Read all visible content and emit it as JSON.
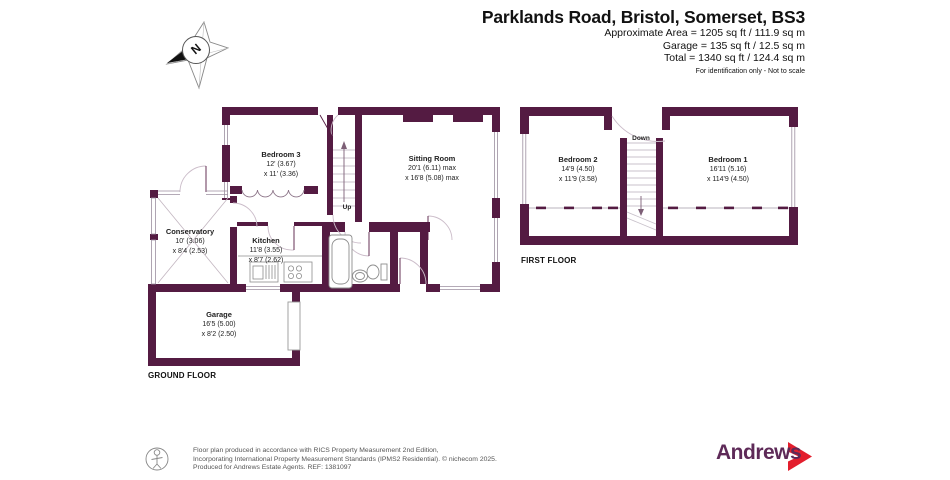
{
  "header": {
    "title": "Parklands Road, Bristol, Somerset, BS3",
    "area_lines": {
      "approx": "Approximate Area = 1205 sq ft / 111.9 sq m",
      "garage": "Garage = 135 sq ft / 12.5 sq m",
      "total": "Total = 1340 sq ft / 124.4 sq m"
    },
    "disclaimer": "For identification only - Not to scale"
  },
  "compass": {
    "north_label": "N"
  },
  "ground_floor": {
    "label": "GROUND FLOOR",
    "stairs_label": "Up",
    "rooms": {
      "bedroom3": {
        "name": "Bedroom 3",
        "dim1": "12' (3.67)",
        "dim2": "x 11' (3.36)"
      },
      "sitting_room": {
        "name": "Sitting Room",
        "dim1": "20'1 (6.11) max",
        "dim2": "x 16'8 (5.08) max"
      },
      "conservatory": {
        "name": "Conservatory",
        "dim1": "10' (3.06)",
        "dim2": "x 8'4 (2.53)"
      },
      "kitchen": {
        "name": "Kitchen",
        "dim1": "11'8 (3.55)",
        "dim2": "x 8'7 (2.62)"
      },
      "garage": {
        "name": "Garage",
        "dim1": "16'5 (5.00)",
        "dim2": "x 8'2 (2.50)"
      }
    }
  },
  "first_floor": {
    "label": "FIRST FLOOR",
    "stairs_label": "Down",
    "rooms": {
      "bedroom2": {
        "name": "Bedroom 2",
        "dim1": "14'9 (4.50)",
        "dim2": "x 11'9 (3.58)"
      },
      "bedroom1": {
        "name": "Bedroom 1",
        "dim1": "16'11 (5.16)",
        "dim2": "x 114'9 (4.50)"
      }
    }
  },
  "footer": {
    "line1": "Floor plan produced in accordance with RICS Property Measurement 2nd Edition,",
    "line2": "Incorporating International Property Measurement Standards (IPMS2 Residential).  © nichecom 2025.",
    "line3": "Produced for Andrews Estate Agents.   REF: 1381097"
  },
  "logo": {
    "brand": "Andrews"
  },
  "colors": {
    "wall": "#541b42",
    "logo_purple": "#5e2a58",
    "logo_red": "#e31e2d"
  }
}
